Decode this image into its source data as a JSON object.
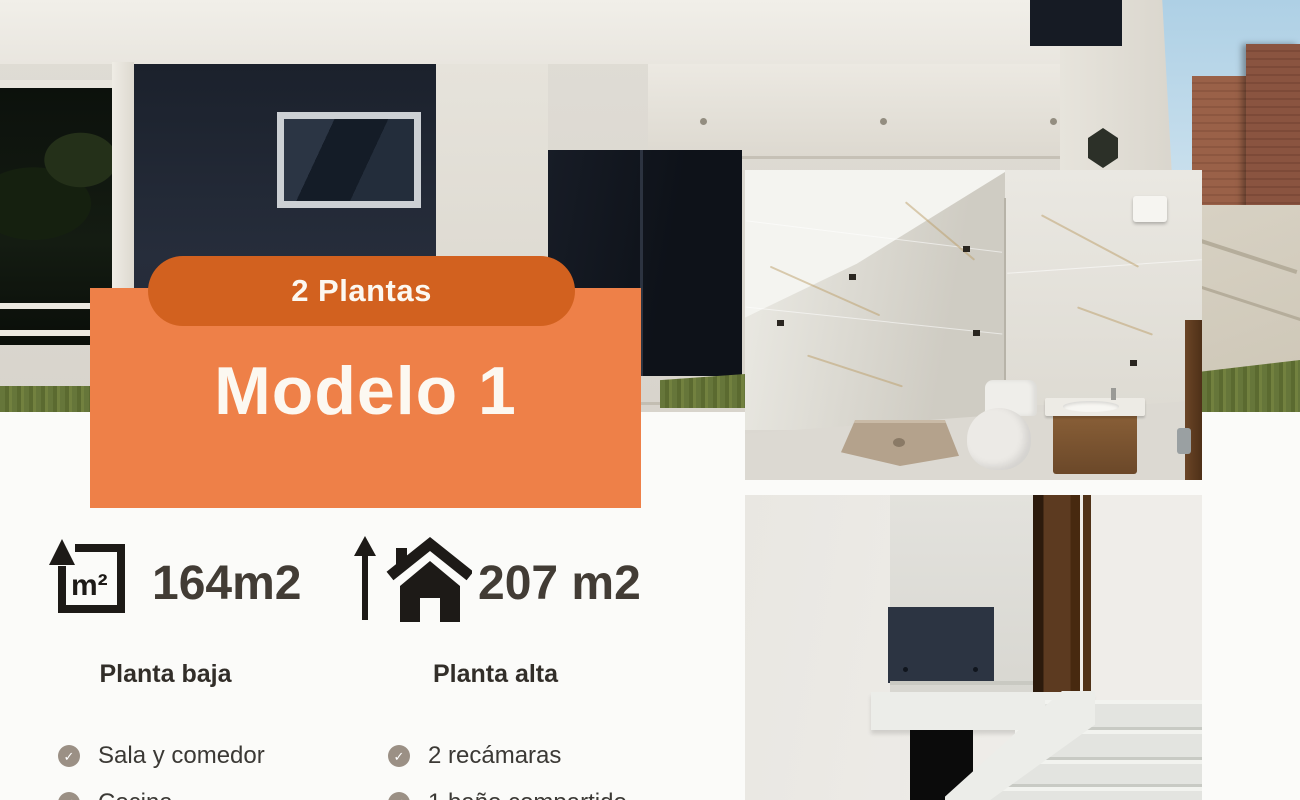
{
  "flyer": {
    "badge_label": "2 Plantas",
    "model_title": "Modelo 1",
    "ground_area": "164m2",
    "upper_area": "207 m2",
    "ground_heading": "Planta baja",
    "upper_heading": "Planta alta",
    "ground_items": [
      "Sala y comedor",
      "Cocina"
    ],
    "upper_items": [
      "2 recámaras",
      "1 baño compartido"
    ],
    "icons": {
      "ground_area_icon": "m2-square-arrow-icon",
      "upper_area_icon": "arrow-house-icon",
      "list_icon": "check-circle-icon",
      "m2_label": "m²",
      "check_glyph": "✓"
    },
    "colors": {
      "card_orange": "#EE8048",
      "badge_orange": "#D2611F",
      "title_white": "#FCF8F1",
      "text_dark": "#3B3935",
      "check_circle": "#9B9085",
      "house_navy": "#232936",
      "background": "#FBFBF9"
    }
  }
}
